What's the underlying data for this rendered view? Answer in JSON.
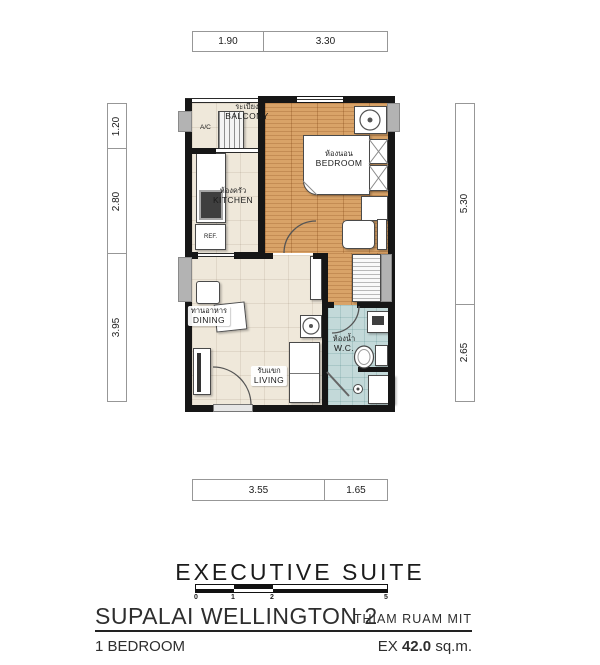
{
  "dims": {
    "top": [
      "1.90",
      "3.30"
    ],
    "left": [
      "1.20",
      "2.80",
      "3.95"
    ],
    "right": [
      "5.30",
      "2.65"
    ],
    "bottom": [
      "3.55",
      "1.65"
    ]
  },
  "rooms": {
    "balcony": {
      "th": "ระเบียง",
      "en": "BALCONY"
    },
    "kitchen": {
      "th": "ห้องครัว",
      "en": "KITCHEN"
    },
    "bedroom": {
      "th": "ห้องนอน",
      "en": "BEDROOM"
    },
    "dining": {
      "th": "ทานอาหาร",
      "en": "DINING"
    },
    "living": {
      "th": "รับแขก",
      "en": "LIVING"
    },
    "wc": {
      "th": "ห้องน้ำ",
      "en": "W.C."
    }
  },
  "fixtures": {
    "ac": "A/C",
    "ref": "REF."
  },
  "scalebar": {
    "t0": "0",
    "t1": "1",
    "t2": "2",
    "t5": "5"
  },
  "footer": {
    "suite": "EXECUTIVE SUITE",
    "project": "SUPALAI WELLINGTON 2",
    "location": "THIAM RUAM MIT",
    "unit": "1 BEDROOM",
    "area_prefix": "EX",
    "area_value": "42.0",
    "area_unit": "sq.m."
  },
  "colors": {
    "wood": "#d9a368",
    "tile": "#efe8da",
    "wc_tile": "#c3d9d9",
    "wall": "#161616"
  }
}
